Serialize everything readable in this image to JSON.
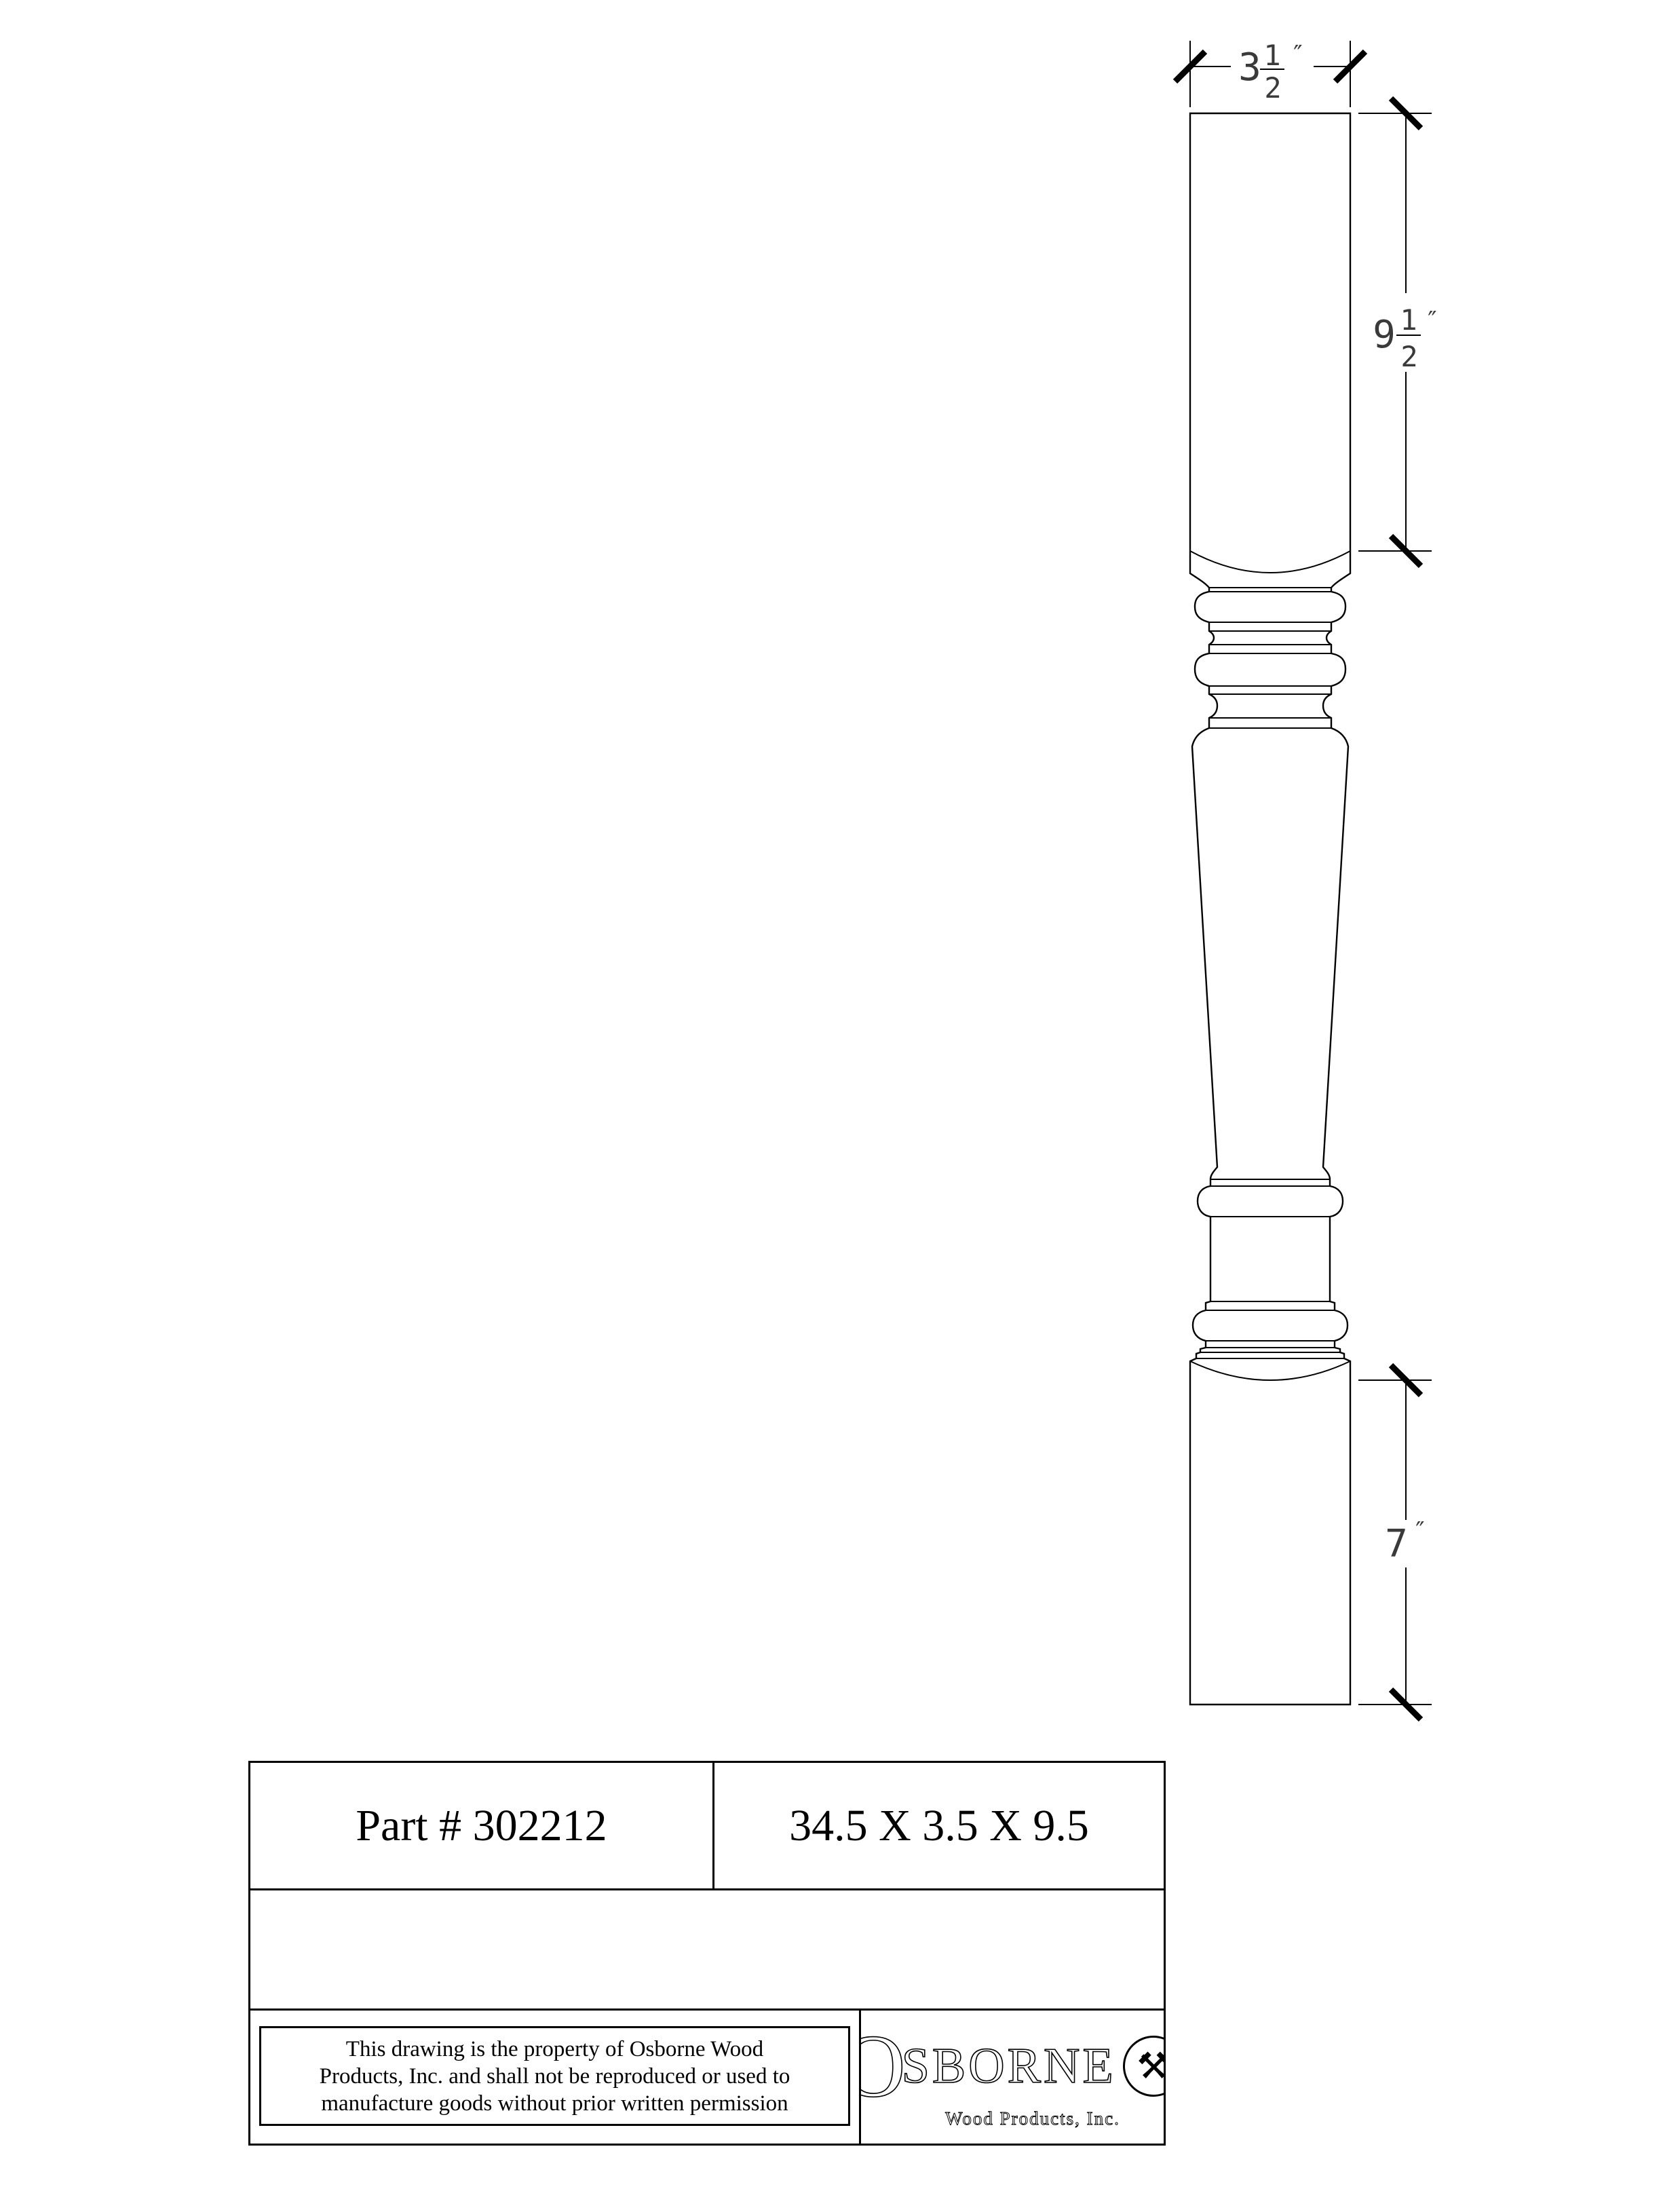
{
  "sheet": {
    "background": "#ffffff",
    "line_color": "#000000",
    "dim_text_color": "#3a3a3a"
  },
  "drawing": {
    "dimensions": {
      "width": {
        "whole": "3",
        "numerator": "1",
        "denominator": "2",
        "unit": "″"
      },
      "square_top": {
        "whole": "9",
        "numerator": "1",
        "denominator": "2",
        "unit": "″"
      },
      "foot": {
        "whole": "7",
        "unit": "″"
      }
    }
  },
  "title_block": {
    "part_number": "Part # 302212",
    "overall_size": "34.5 X 3.5 X 9.5",
    "disclaimer": {
      "line1": "This drawing is the property of Osborne Wood",
      "line2": "Products, Inc. and shall not be reproduced or used to",
      "line3": "manufacture goods without prior written permission"
    },
    "logo": {
      "initial": "O",
      "name_rest": "SBORNE",
      "emblem": "⚒",
      "subtitle": "Wood Products, Inc."
    }
  }
}
